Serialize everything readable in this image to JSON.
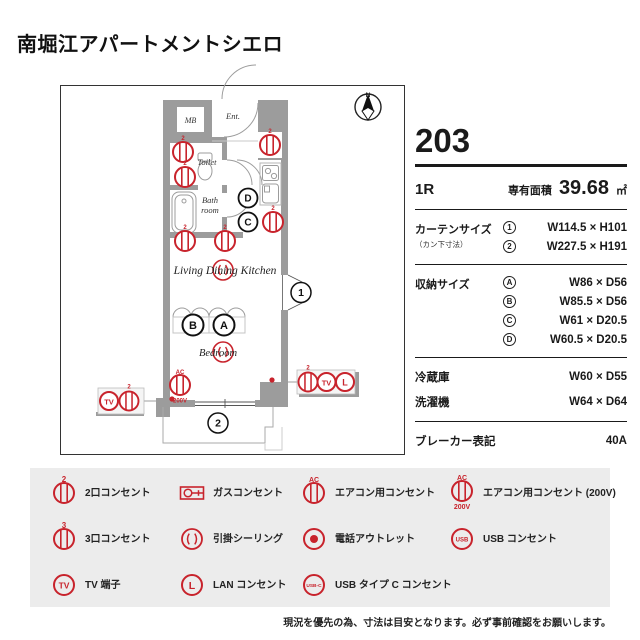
{
  "title": "南堀江アパートメントシエロ",
  "unit": {
    "number": "203",
    "layout": "1R",
    "area_label": "専有面積",
    "area_value": "39.68",
    "area_unit": "㎡"
  },
  "specs": {
    "curtain": {
      "label": "カーテンサイズ",
      "sublabel": "（カン下寸法）",
      "rows": [
        {
          "mark": "1",
          "value": "W114.5 × H101"
        },
        {
          "mark": "2",
          "value": "W227.5 × H191"
        }
      ]
    },
    "storage": {
      "label": "収納サイズ",
      "rows": [
        {
          "mark": "A",
          "value": "W86 × D56"
        },
        {
          "mark": "B",
          "value": "W85.5 × D56"
        },
        {
          "mark": "C",
          "value": "W61 × D20.5"
        },
        {
          "mark": "D",
          "value": "W60.5 × D20.5"
        }
      ]
    },
    "fridge": {
      "label": "冷蔵庫",
      "value": "W60 × D55"
    },
    "washer": {
      "label": "洗濯機",
      "value": "W64 × D64"
    },
    "breaker": {
      "label": "ブレーカー表記",
      "value": "40A"
    }
  },
  "plan": {
    "rooms": {
      "mb": "MB",
      "ent": "Ent.",
      "toilet": "Toilet",
      "bath_line1": "Bath",
      "bath_line2": "room",
      "ldk": "Living Dining Kitchen",
      "bedroom": "Bedroom"
    },
    "marks": {
      "north": "N",
      "a": "A",
      "b": "B",
      "c": "C",
      "d": "D",
      "win1": "1",
      "win2": "2",
      "num2": "2",
      "ac": "AC",
      "v200": "200V",
      "tv": "TV",
      "lan": "L"
    }
  },
  "legend": {
    "items": [
      {
        "icon": "outlet-2",
        "label": "2口コンセント"
      },
      {
        "icon": "gas",
        "label": "ガスコンセント"
      },
      {
        "icon": "ac",
        "label": "エアコン用コンセント"
      },
      {
        "icon": "ac-200v",
        "label": "エアコン用コンセント (200V)"
      },
      {
        "icon": "outlet-3",
        "label": "3口コンセント"
      },
      {
        "icon": "ceiling",
        "label": "引掛シーリング"
      },
      {
        "icon": "phone",
        "label": "電話アウトレット"
      },
      {
        "icon": "usb",
        "label": "USB コンセント"
      },
      {
        "icon": "tv",
        "label": "TV 端子"
      },
      {
        "icon": "lan",
        "label": "LAN コンセント"
      },
      {
        "icon": "usb-c",
        "label": "USB タイプ C コンセント"
      }
    ],
    "icon_texts": {
      "n2": "2",
      "n3": "3",
      "ac": "AC",
      "v200": "200V",
      "tv": "TV",
      "lan": "L",
      "usb": "USB",
      "usbc": "USB-C"
    }
  },
  "footer": {
    "disclaimer": "現況を優先の為、寸法は目安となります。必ず事前確認をお願いします。"
  },
  "colors": {
    "accent_red": "#c8232c",
    "wall_gray": "#9c9c9c",
    "legend_bg": "#ececec"
  }
}
